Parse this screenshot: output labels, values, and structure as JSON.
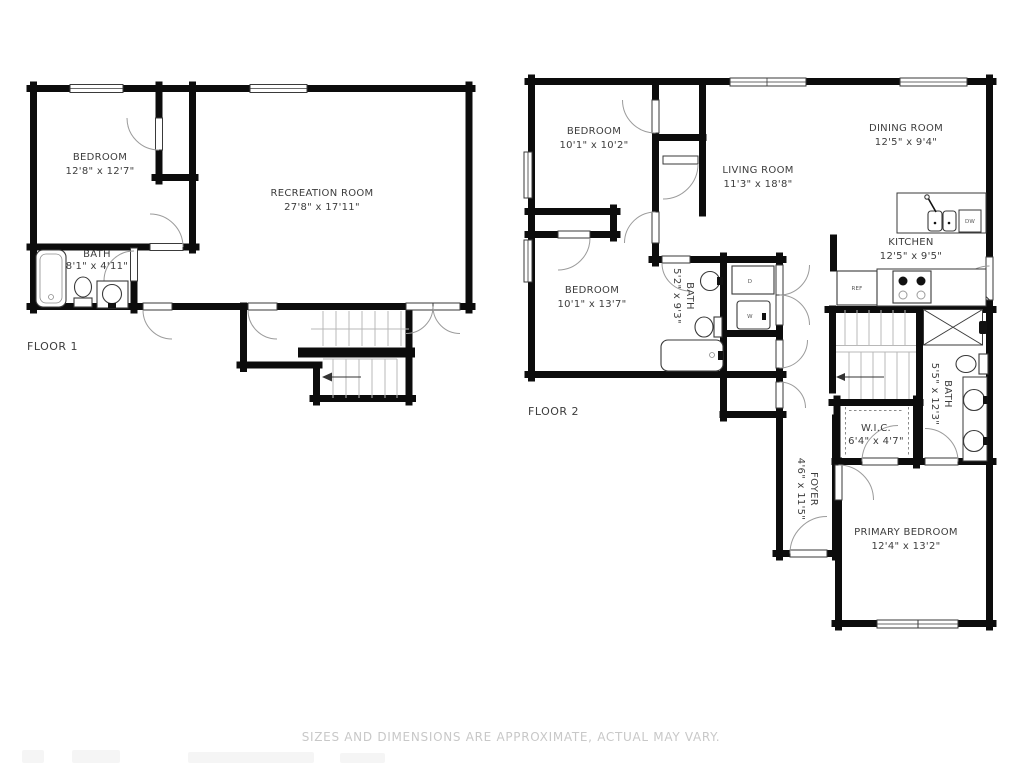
{
  "title": "Two-floor residential floor plan",
  "colors": {
    "wall": "#0c0c0c",
    "label": "#3d3d3d",
    "disclaimer": "#c8c8c8",
    "door_arc": "#9b9b9b",
    "stairs": "#b8b8b8"
  },
  "floor1": {
    "label": "FLOOR 1",
    "rooms": {
      "bedroom": {
        "name": "BEDROOM",
        "dims": "12'8\" x 12'7\""
      },
      "bath": {
        "name": "BATH",
        "dims": "8'1\" x 4'11\""
      },
      "recreation": {
        "name": "RECREATION ROOM",
        "dims": "27'8\" x 17'11\""
      }
    }
  },
  "floor2": {
    "label": "FLOOR 2",
    "rooms": {
      "bedroom_top": {
        "name": "BEDROOM",
        "dims": "10'1\" x 10'2\""
      },
      "dining": {
        "name": "DINING ROOM",
        "dims": "12'5\" x 9'4\""
      },
      "living": {
        "name": "LIVING ROOM",
        "dims": "11'3\" x 18'8\""
      },
      "kitchen": {
        "name": "KITCHEN",
        "dims": "12'5\" x 9'5\""
      },
      "bedroom_mid": {
        "name": "BEDROOM",
        "dims": "10'1\" x 13'7\""
      },
      "bath_hall": {
        "name": "BATH",
        "dims": "5'2\" x 9'3\""
      },
      "bath_primary": {
        "name": "BATH",
        "dims": "5'5\" x 12'3\""
      },
      "wic": {
        "name": "W.I.C.",
        "dims": "6'4\" x 4'7\""
      },
      "foyer": {
        "name": "FOYER",
        "dims": "4'6\" x 11'5\""
      },
      "primary": {
        "name": "PRIMARY BEDROOM",
        "dims": "12'4\" x 13'2\""
      }
    },
    "appliances": {
      "dw": "DW",
      "ref": "REF",
      "washer": "W",
      "dryer": "D"
    }
  },
  "footer": {
    "disclaimer": "SIZES AND DIMENSIONS ARE APPROXIMATE, ACTUAL MAY VARY."
  }
}
